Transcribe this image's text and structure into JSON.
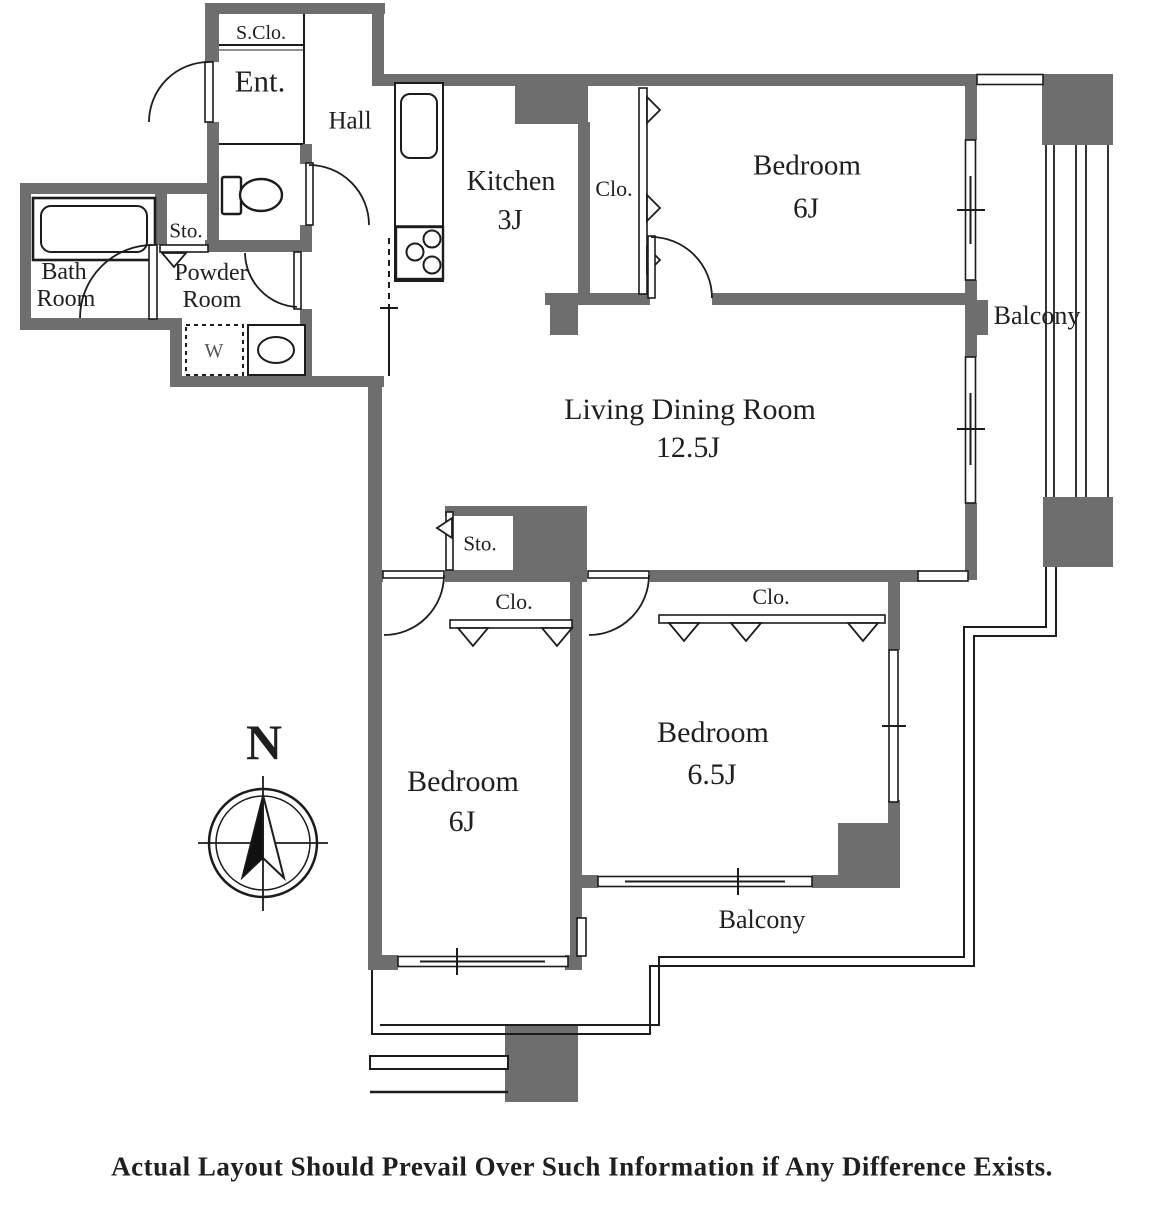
{
  "floorplan": {
    "labels": {
      "s_clo": "S.Clo.",
      "ent": "Ent.",
      "hall": "Hall",
      "kitchen": "Kitchen",
      "kitchen_size": "3J",
      "clo_upper": "Clo.",
      "bedroom_top": "Bedroom",
      "bedroom_top_size": "6J",
      "balcony_right": "Balcony",
      "living": "Living Dining Room",
      "living_size": "12.5J",
      "bath_1": "Bath",
      "bath_2": "Room",
      "sto_upper": "Sto.",
      "powder_1": "Powder",
      "powder_2": "Room",
      "washer": "W",
      "sto_mid": "Sto.",
      "clo_left": "Clo.",
      "clo_right": "Clo.",
      "bedroom_left": "Bedroom",
      "bedroom_left_size": "6J",
      "bedroom_right": "Bedroom",
      "bedroom_right_size": "6.5J",
      "balcony_bottom": "Balcony",
      "north": "N"
    },
    "disclaimer": "Actual Layout Should Prevail Over Such Information if Any Difference Exists.",
    "colors": {
      "wall": "#6e6e6e",
      "line": "#1c1c1c"
    }
  }
}
